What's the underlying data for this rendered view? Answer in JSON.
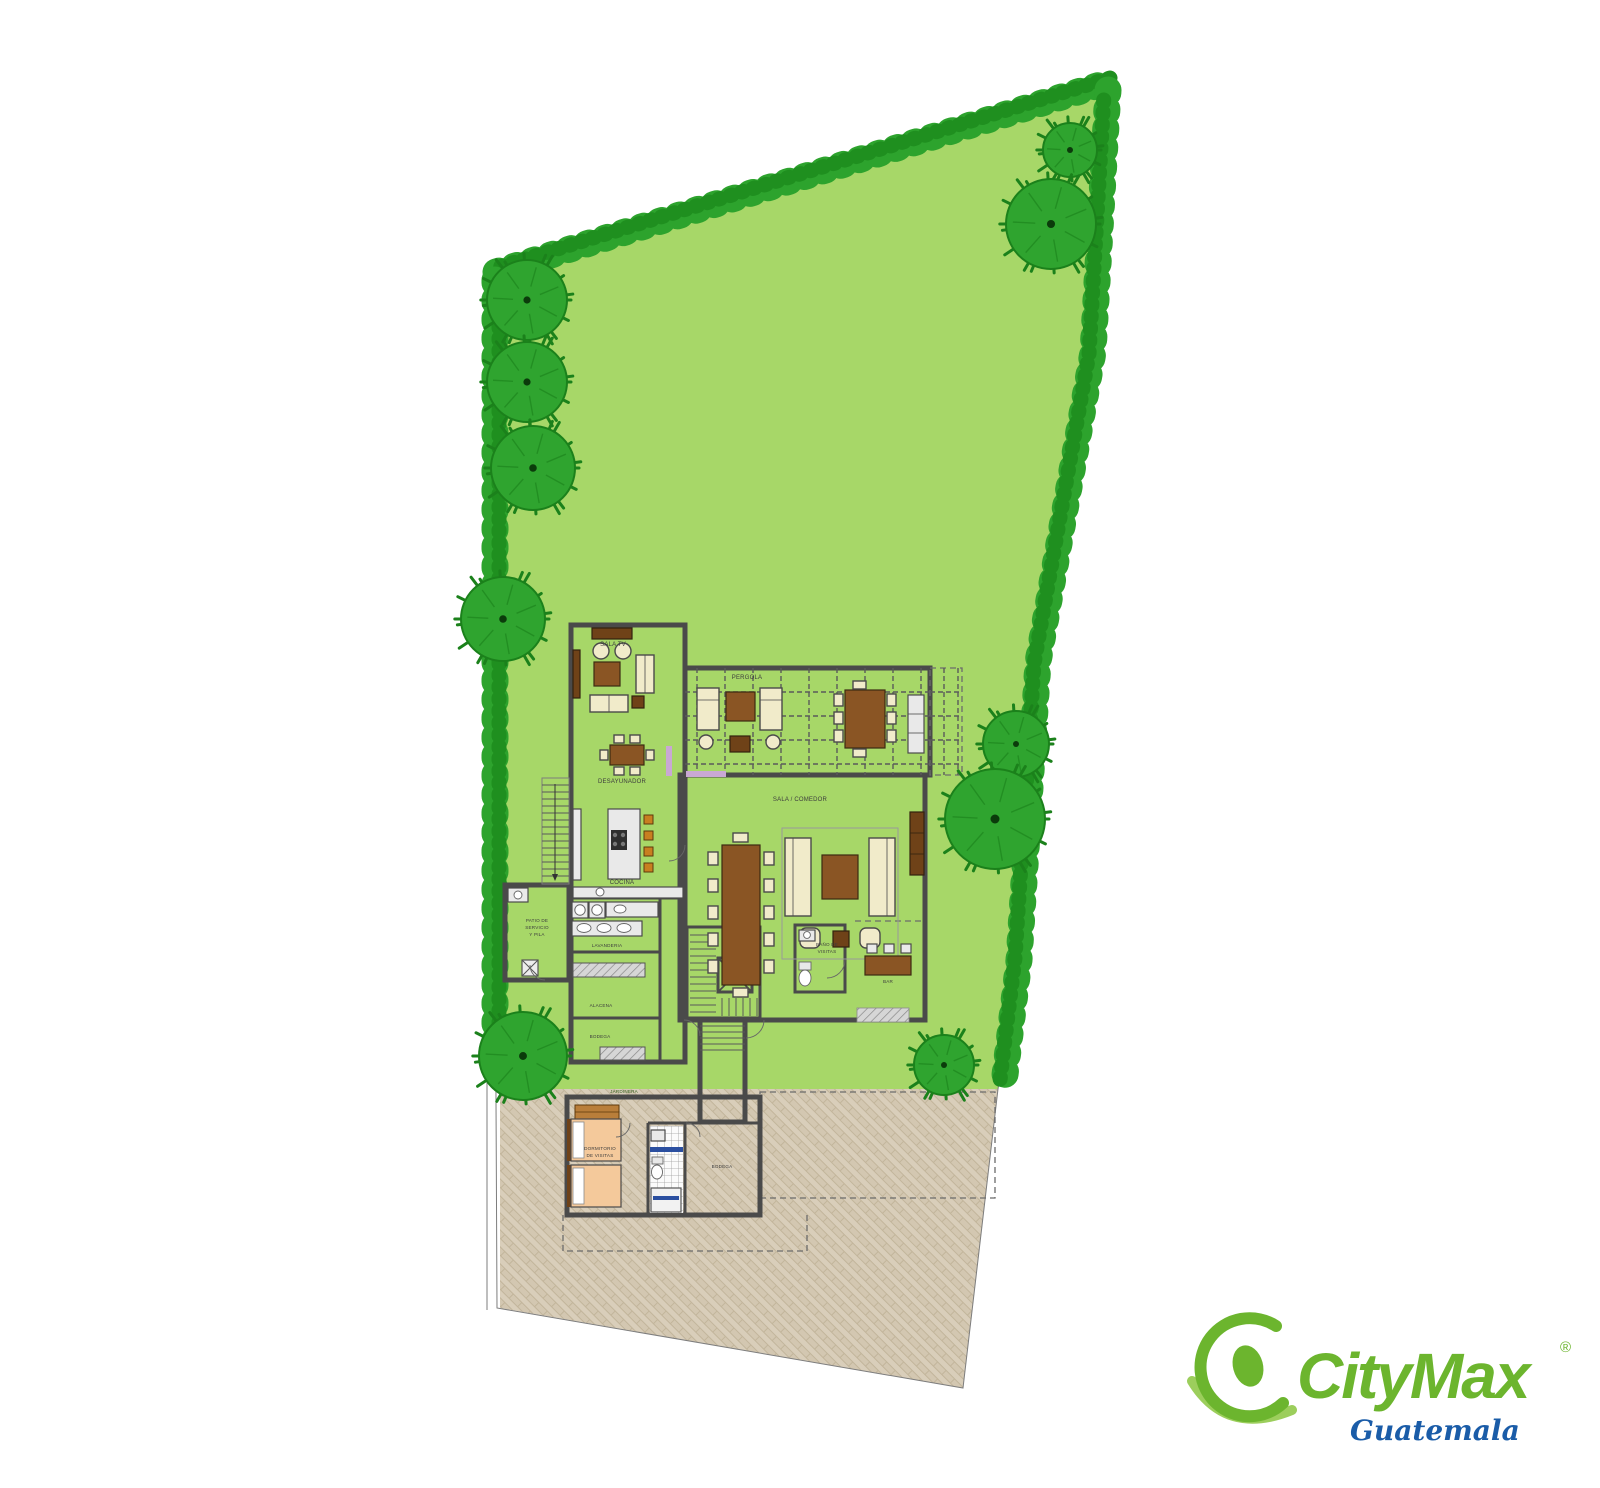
{
  "document": {
    "kind": "residential site plan with ground-floor plan"
  },
  "plan": {
    "labels": {
      "sala_tv": "SALA TV",
      "desayunador": "DESAYUNADOR",
      "cocina": "COCINA",
      "pergola": "PERGOLA",
      "sala_comedor": "SALA / COMEDOR",
      "lavanderia": "LAVANDERIA",
      "alacena": "ALACENA",
      "bodega": "BODEGA",
      "patio_1": "PATIO DE",
      "patio_2": "SERVICIO",
      "patio_3": "Y PILA",
      "bano_1": "BAÑO DE",
      "bano_2": "VISITAS",
      "bar": "BAR",
      "jardinera": "JARDINERA",
      "dormitorio_1": "DORMITORIO",
      "dormitorio_2": "DE VISITAS",
      "bodega_visitas": "BODEGA"
    }
  },
  "landscape": {
    "trees": [
      {
        "x": 1070,
        "y": 150,
        "r": 27
      },
      {
        "x": 1051,
        "y": 224,
        "r": 45
      },
      {
        "x": 527,
        "y": 300,
        "r": 40
      },
      {
        "x": 527,
        "y": 382,
        "r": 40
      },
      {
        "x": 533,
        "y": 468,
        "r": 42
      },
      {
        "x": 503,
        "y": 619,
        "r": 42
      },
      {
        "x": 1016,
        "y": 744,
        "r": 33
      },
      {
        "x": 995,
        "y": 819,
        "r": 50
      },
      {
        "x": 523,
        "y": 1056,
        "r": 44
      },
      {
        "x": 944,
        "y": 1065,
        "r": 30
      }
    ]
  },
  "palette": {
    "lawn": "#a7d768",
    "hedge": "#2da32d",
    "hedge_dark": "#1f8f1f",
    "tree_fill": "#2fa42f",
    "tree_stroke": "#1b811b",
    "tree_core": "#0b3b0b",
    "wall": "#4a4a4a",
    "floor": "#dedede",
    "paving": "#d9ceba",
    "paving_line": "#c2b59b",
    "accent_lavender": "#c9a8d4",
    "accent_blue": "#2b4fa0",
    "bed_tan": "#f4c99b"
  },
  "logo": {
    "brand": "CityMax",
    "registered": "®",
    "region": "Guatemala",
    "brand_color": "#6cb52e",
    "swoosh_color": "#8bc53f",
    "region_color": "#1a5ca8"
  }
}
